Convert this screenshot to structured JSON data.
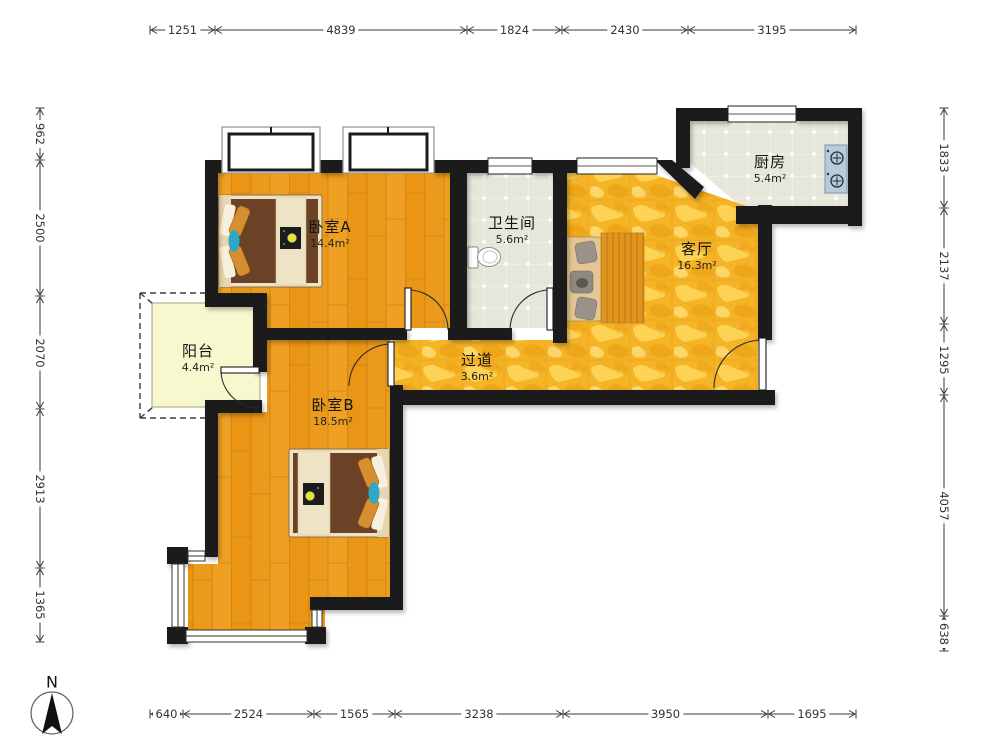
{
  "rooms": [
    {
      "id": "bedroom-a",
      "name": "卧室A",
      "area": "14.4m²"
    },
    {
      "id": "bathroom",
      "name": "卫生间",
      "area": "5.6m²"
    },
    {
      "id": "kitchen",
      "name": "厨房",
      "area": "5.4m²"
    },
    {
      "id": "living-room",
      "name": "客厅",
      "area": "16.3m²"
    },
    {
      "id": "corridor",
      "name": "过道",
      "area": "3.6m²"
    },
    {
      "id": "balcony",
      "name": "阳台",
      "area": "4.4m²"
    },
    {
      "id": "bedroom-b",
      "name": "卧室B",
      "area": "18.5m²"
    }
  ],
  "dimensions": {
    "top": [
      "1251",
      "4839",
      "1824",
      "2430",
      "3195"
    ],
    "bottom": [
      "640",
      "2524",
      "1565",
      "3238",
      "3950",
      "1695"
    ],
    "left": [
      "962",
      "2500",
      "2070",
      "2913",
      "1365"
    ],
    "right": [
      "1833",
      "2137",
      "1295",
      "4057",
      "638"
    ]
  },
  "north_label": "N",
  "colors": {
    "wall": "#1b1b1b",
    "wood_floor": "#EC9A1B",
    "gold_floor": "#F4B426",
    "tile_floor": "#E6E6DB",
    "balcony_floor": "#F8F8CE",
    "bed_duvet": "#6B4226",
    "bed_frame": "#EFE3C6",
    "pillow_orange": "#D78E2E",
    "accent_teal": "#2FA8C4",
    "stove_blue": "#B5CCDE",
    "dimension_text": "#333333"
  }
}
